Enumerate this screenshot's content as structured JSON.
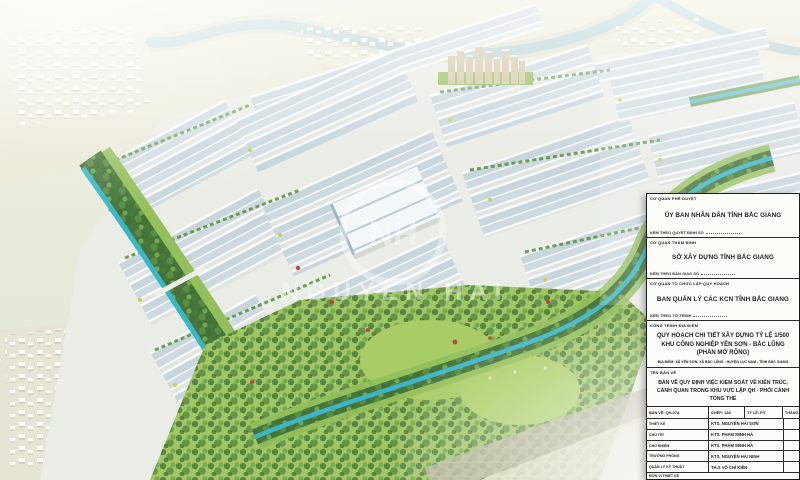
{
  "palette": {
    "canal": "#2fb4c8",
    "river": "#a9c7cb",
    "tree_dark": "#3c6e2f",
    "lawn": "#9cc45c",
    "roof_blue": "#c9d5db",
    "haze_white": "#ffffff",
    "panel_bg": "#fcfcf9",
    "panel_border": "#1c1c1c",
    "accent_red": "#b8402e",
    "accent_yellow": "#c8cf43",
    "tower_tan": "#cdc09a"
  },
  "watermark": {
    "monogram": "NH",
    "text": "NGUYEN HAI"
  },
  "title_block": {
    "approvals": [
      {
        "label": "CƠ QUAN PHÊ DUYỆT",
        "name": "ỦY BAN NHÂN DÂN TỈNH BẮC GIANG",
        "note": "KÈM THEO QUYẾT ĐỊNH SỐ"
      },
      {
        "label": "CƠ QUAN THẨM ĐỊNH",
        "name": "SỞ XÂY DỰNG TỈNH BẮC GIANG",
        "note": "KÈM THEO BÀN GIAO SỐ"
      },
      {
        "label": "CƠ QUAN TỔ CHỨC LẬP QUY HOẠCH",
        "name": "BAN QUẢN LÝ CÁC KCN TỈNH BẮC GIANG",
        "note": "KÈM THEO TỜ TRÌNH"
      }
    ],
    "project": {
      "label": "CÔNG TRÌNH ĐỊA ĐIỂM",
      "line1": "QUY HOẠCH CHI TIẾT XÂY DỰNG TỶ LỆ 1/500",
      "line2": "KHU CÔNG NGHIỆP YÊN SƠN - BẮC LŨNG",
      "line3": "(PHẦN MỞ RỘNG)",
      "address": "ĐỊA ĐIỂM: XÃ YÊN SƠN, XÃ BẮC LŨNG - HUYỆN LỤC NAM - TỈNH BẮC GIANG"
    },
    "drawing": {
      "label": "TÊN BẢN VẼ",
      "line1": "BẢN VẼ QUY ĐỊNH VIỆC KIỂM SOÁT VỀ KIẾN TRÚC,",
      "line2": "CẢNH QUAN TRONG KHU VỰC LẬP QH - PHỐI CẢNH TỔNG THỂ"
    },
    "table": {
      "header": {
        "sheet": "BẢN VẼ: QH-07A",
        "set": "GHÉP: 1A0",
        "scale": "TỶ LỆ: P/T",
        "month": "THÁNG: 2023"
      },
      "rows": [
        {
          "role": "THIẾT KẾ",
          "person": "KTS. NGUYỄN HẢI SƠN"
        },
        {
          "role": "CHỦ TRÌ",
          "person": "KTS. PHẠM MINH HÀ"
        },
        {
          "role": "CHỦ NHIỆM",
          "person": "KTS. PHẠM MINH HÀ"
        },
        {
          "role": "TRƯỞNG PHÒNG",
          "person": "KTS. NGUYỄN HẢI NINH"
        },
        {
          "role": "QUẢN LÝ KỸ THUẬT",
          "person": "TH.S VÕ CHÍ KIÊN"
        }
      ],
      "footer": "ĐƠN VỊ THIẾT KẾ"
    }
  }
}
